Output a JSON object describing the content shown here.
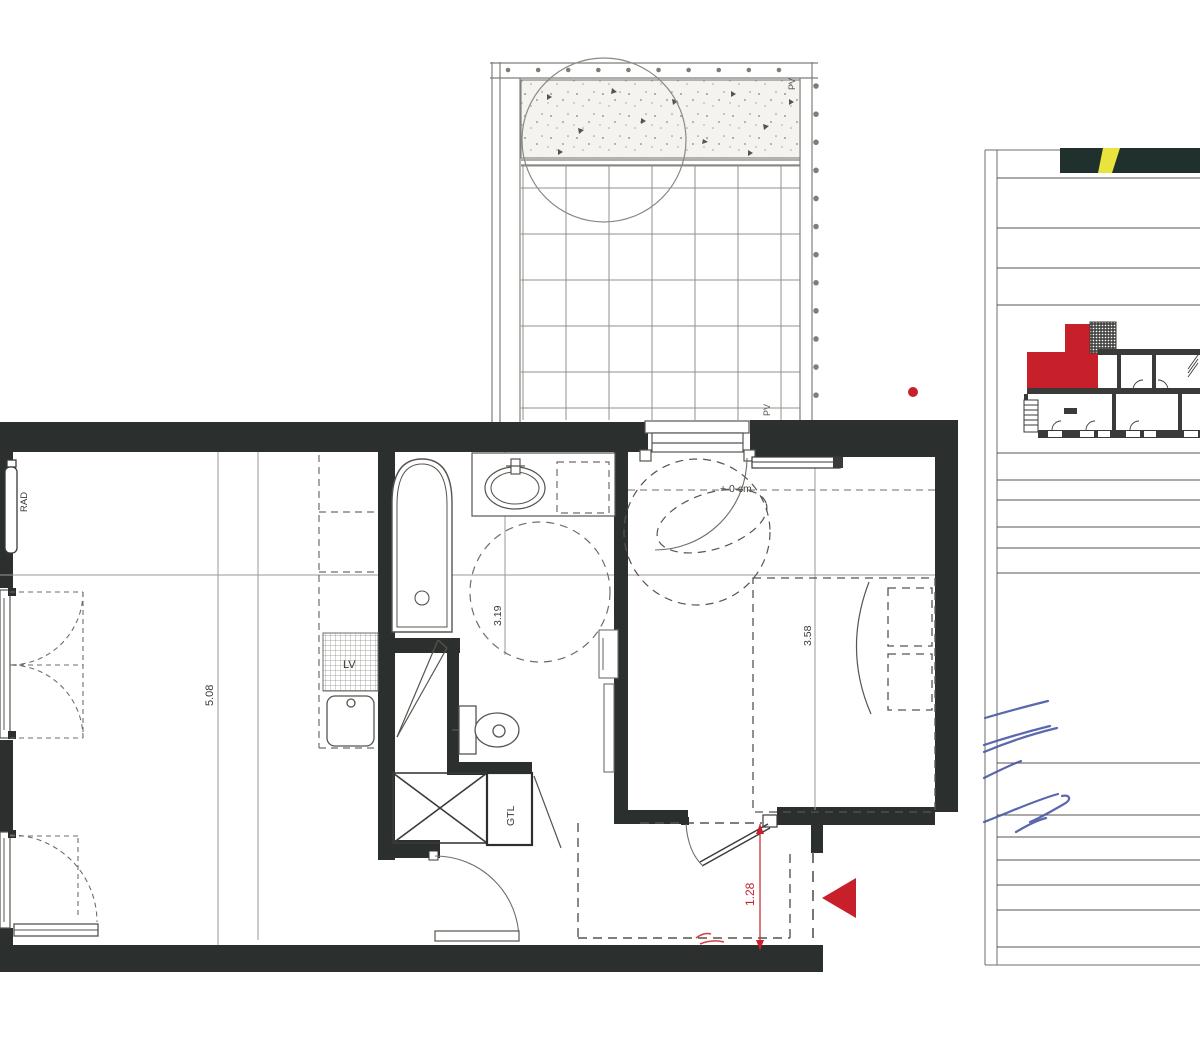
{
  "plan": {
    "labels": {
      "radiator": "RAD",
      "dishwasher": "LV",
      "utility_shaft": "GTL",
      "terrace_pv_top": "PV",
      "terrace_pv_bottom": "PV",
      "floor_level": "+ 0 cm"
    },
    "dimensions": {
      "living_room_depth": "5.08",
      "bathroom_width": "3.19",
      "bedroom_depth": "3.58",
      "entry_width": "1.28"
    }
  },
  "colors": {
    "wall": "#2b302e",
    "line": "#8c8c8c",
    "red": "#c8202b",
    "blue": "#4a57a6",
    "yellow": "#e9e43d"
  }
}
